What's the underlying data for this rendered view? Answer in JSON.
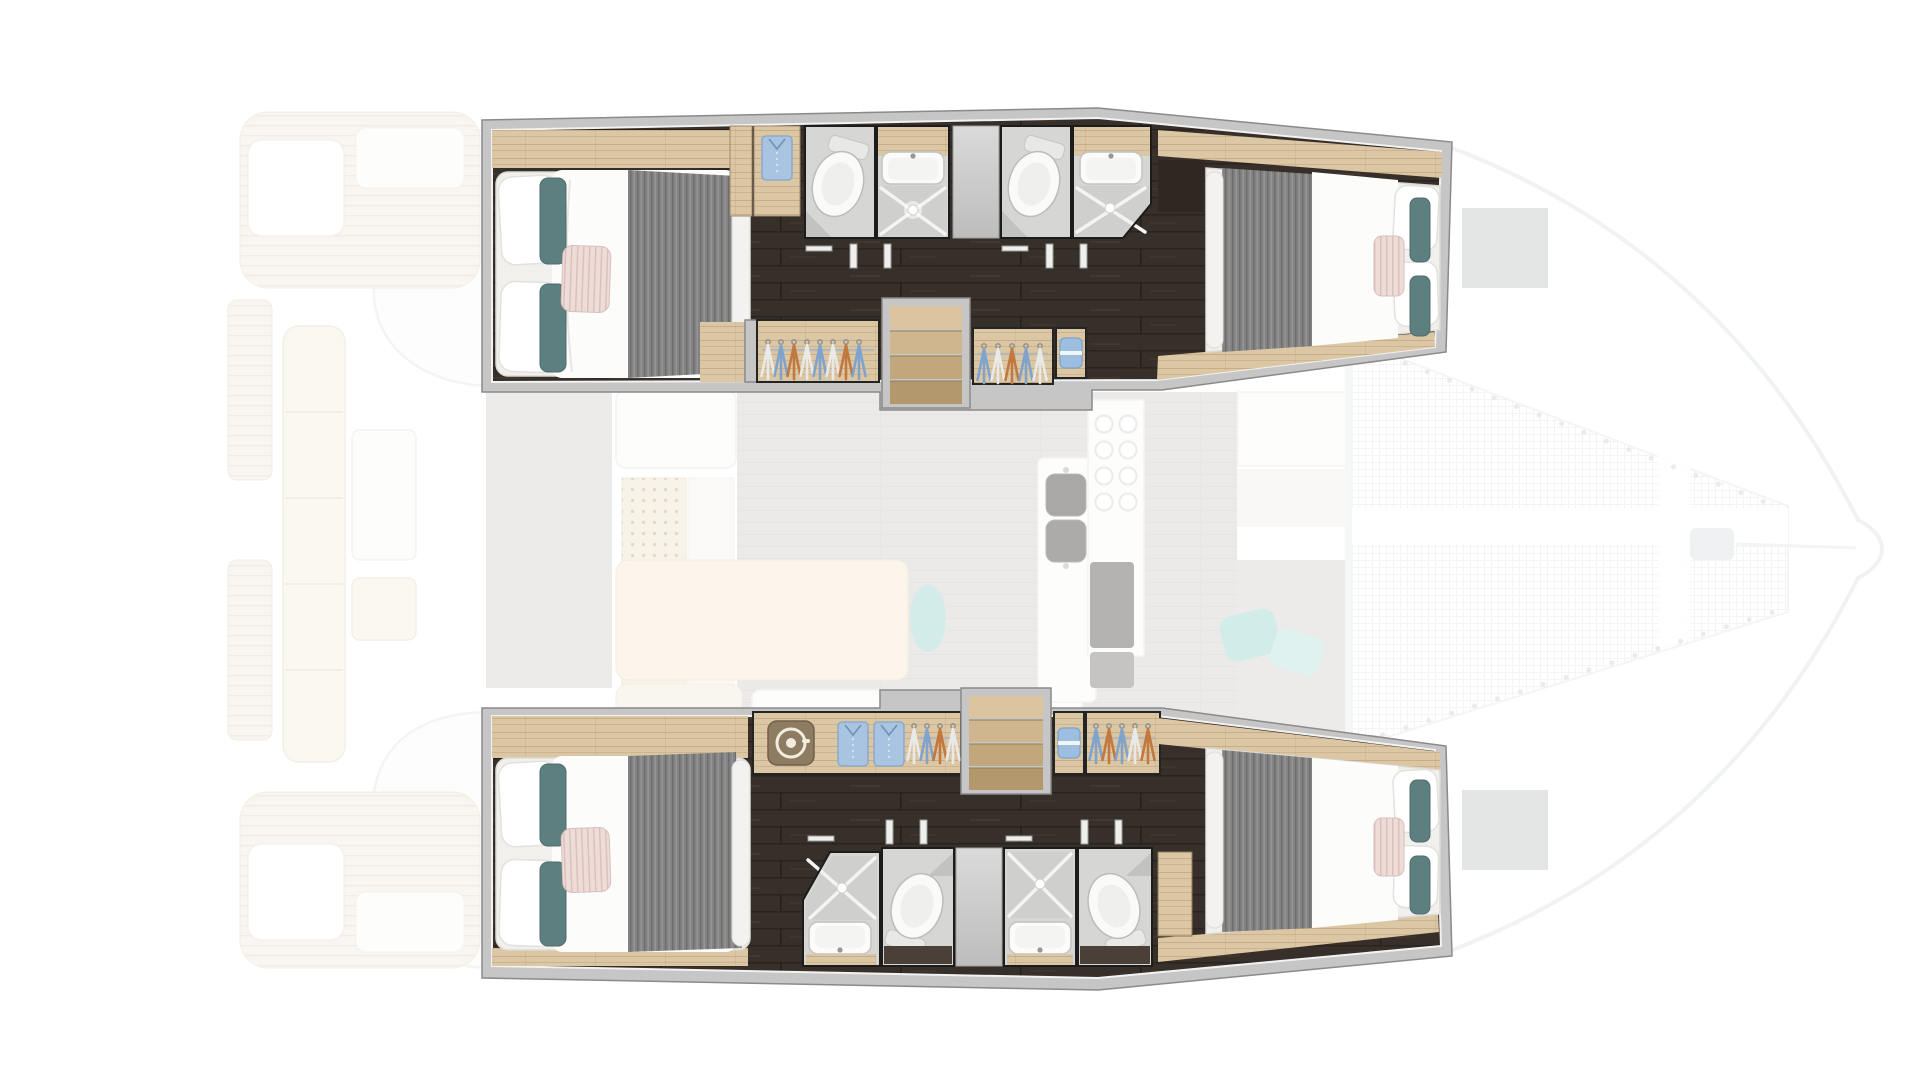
{
  "scene": {
    "description": "Top-down floor plan of a sailing catamaran, bow to the right. Four double cabins and four bathrooms in the two hulls are highlighted in full colour; the saloon, galley, cockpit, stern decks and bow trampoline are shown faded.",
    "view": "top-down",
    "boat_type": "catamaran",
    "orientation": "bow-right",
    "highlighted_zones": [
      "top-hull-accommodation",
      "bottom-hull-accommodation"
    ],
    "faded_zones": [
      "saloon",
      "galley",
      "cockpit",
      "stern-decks",
      "foredeck-trampoline"
    ]
  },
  "counts": {
    "double_cabins": 4,
    "bathrooms": 4,
    "shower_cubicles": 4,
    "toilets": 4,
    "washbasins": 4,
    "wardrobes": 4,
    "staircases": 2,
    "washing_machine": 1,
    "bow_hatches": 2
  },
  "icons": [
    "double-bed-icon",
    "pillow-icon",
    "toilet-icon",
    "shower-tray-icon",
    "washbasin-icon",
    "hanger-icon",
    "folded-shirt-icon",
    "washing-machine-icon",
    "towel-icon",
    "stairs-icon",
    "galley-sink-icon",
    "burner-icon",
    "trampoline-net",
    "bow-hatch"
  ],
  "palette": {
    "wall_fill": "#c6c6c6",
    "wall_edge": "#8a8a8a",
    "inner_line": "#f2f2f2",
    "floor_dark": "#372f29",
    "wood_light": "#dcc7a4",
    "wood_step_1": "#dcc49e",
    "wood_step_2": "#d0b68e",
    "wood_step_3": "#c2a67c",
    "wood_step_4": "#b3976d",
    "bath_floor": "#d6d6d4",
    "tray": "#cfcfcd",
    "bulkhead": "#cbcbcb",
    "fixture": "#fbfbf9",
    "fixture_edge": "#c2c2c0",
    "mattress": "#f1f0ed",
    "duvet": "#fcfcfb",
    "blanket_gray": "#838383",
    "pillow_teal": "#5d7f7f",
    "pillow_blush": "#eedcd8",
    "cloth_blue": "#7fa3cc",
    "cloth_orange": "#c1793f",
    "cloth_white": "#e9e9e7",
    "shirt_blue": "#a9c4e0",
    "towel_blue": "#9dbede",
    "washer_brown": "#8d7b62",
    "compartment_outline": "#1c1c1c",
    "saloon_floor": "#d7d5d2",
    "deck_cream": "#f6f0e4",
    "teal_cushion": "#a9d9d3",
    "net_line": "#e5e8ea",
    "hatch_gray": "#c9caca",
    "faded_edge": "#e3e6e7",
    "appliance_dark": "#6b6763",
    "sink_dark": "#55514d",
    "peg_dot": "#c9a272"
  }
}
